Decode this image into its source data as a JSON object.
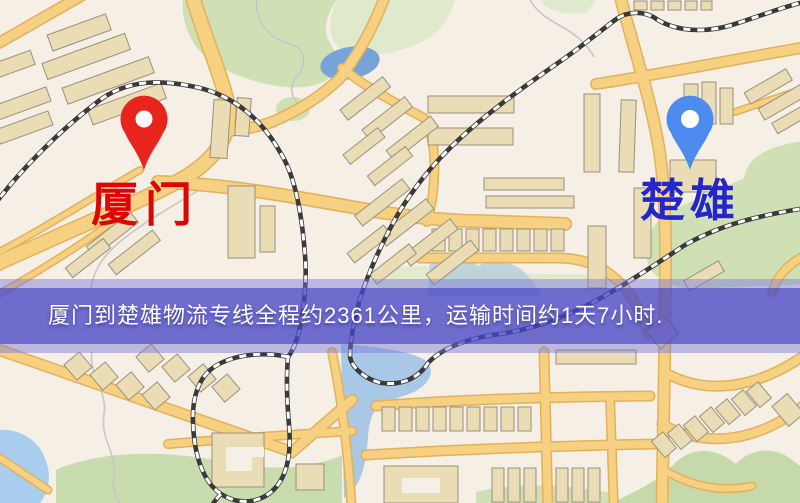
{
  "map": {
    "banner": {
      "text": "厦门到楚雄物流专线全程约2361公里，运输时间约1天7小时.",
      "background_color": "#4946c7",
      "text_color": "#ffffff"
    },
    "markers": [
      {
        "id": "origin",
        "label": "厦门",
        "icon": "map-pin-icon",
        "pin_color": "#e8251d",
        "label_color": "#de0505"
      },
      {
        "id": "destination",
        "label": "楚雄",
        "icon": "map-pin-icon",
        "pin_color": "#4d8bee",
        "label_color": "#2525c8"
      }
    ],
    "palette": {
      "map_background": "#f5efe6",
      "road_fill": "#f6d181",
      "road_casing": "#e3b05b",
      "park_green": "#cfe0b5",
      "water_blue": "#a8c8e6",
      "pond_blue": "#76a4d8",
      "building_fill": "#eadcb4",
      "building_outline": "#99917d",
      "railway_dark": "#3a3a3a",
      "railway_light": "#ffffff"
    }
  }
}
